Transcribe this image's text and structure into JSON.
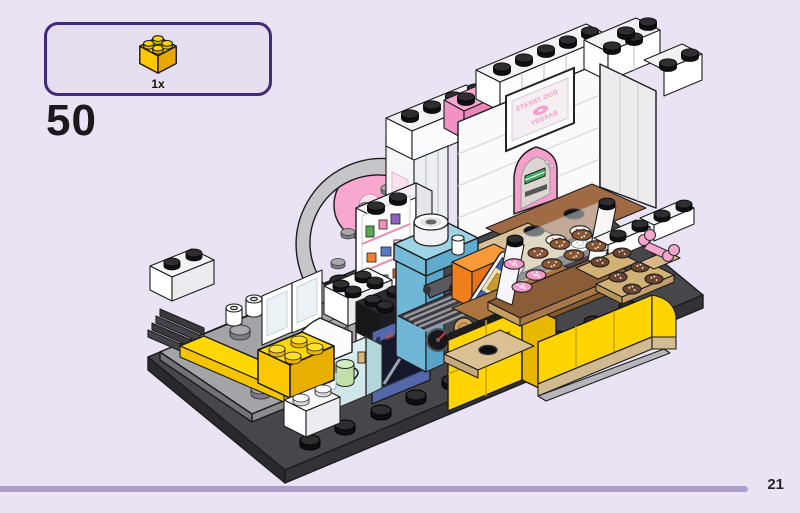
{
  "page": {
    "step_number": "50",
    "page_number": "21",
    "background_color": "#eae3f3"
  },
  "parts_callout": {
    "quantity_label": "1x",
    "part_description": "yellow 2x2 brick",
    "border_color": "#402a7c",
    "fill_color": "#e5deef"
  },
  "footer": {
    "rule_color": "#ab9ecb"
  },
  "model": {
    "bakery_sign": {
      "line1": "DOG TREATS",
      "line2": "BAKERY",
      "mirrored": true
    },
    "palette": {
      "brick_yellow": "#ffd702",
      "baseplate_dark": "#47474b",
      "plate_gray": "#a4a4a8",
      "wall_white": "#f8f8fa",
      "pink": "#f292c4",
      "light_pink": "#fbe2ee",
      "machine_teal": "#74bad8",
      "counter_orange": "#f5821f",
      "oven_navy": "#5268aa",
      "floor_brown": "#a06a44",
      "tan": "#d8c098",
      "tray_brown": "#8a5c38",
      "donut_pink": "#f49ac8",
      "cookie_brown": "#8a5632",
      "glass_aqua": "#d6edef"
    }
  }
}
